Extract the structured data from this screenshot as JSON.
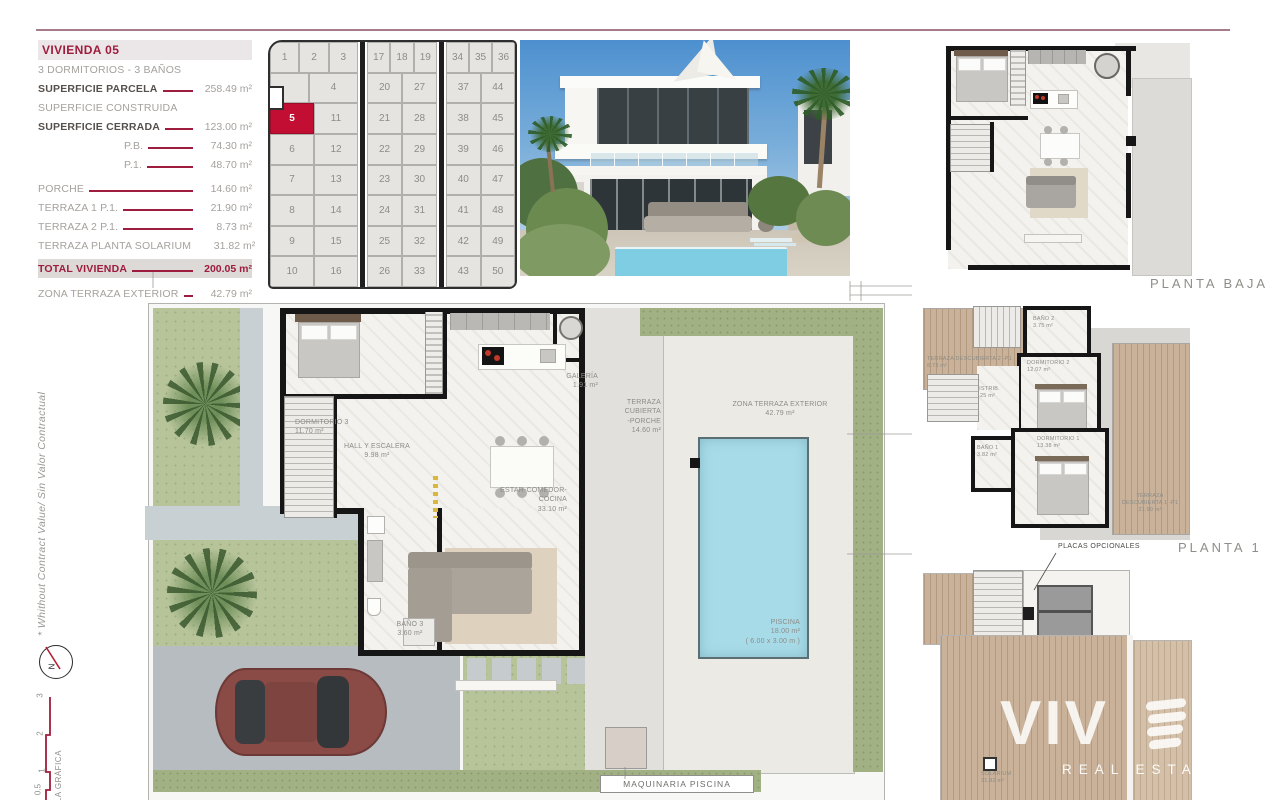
{
  "sheet": {
    "disclaimer": "* Whithout Contract Value/ Sin Valor Contractual",
    "compass_label": "N",
    "scale_title": "ESCALA GRÁFICA",
    "scale_ticks": [
      "3",
      "2",
      "1",
      "0.5"
    ]
  },
  "spec_panel": {
    "title": "VIVIENDA 05",
    "subtitle": "3 DORMITORIOS - 3 BAÑOS",
    "rows": [
      {
        "label": "SUPERFICIE PARCELA",
        "value": "258.49 m²"
      },
      {
        "label": "SUPERFICIE CONSTRUIDA",
        "value": ""
      },
      {
        "label": "SUPERFICIE CERRADA",
        "value": "123.00 m²"
      },
      {
        "label": "P.B.",
        "value": "74.30 m²"
      },
      {
        "label": "P.1.",
        "value": "48.70 m²"
      },
      {
        "label": "PORCHE",
        "value": "14.60 m²"
      },
      {
        "label": "TERRAZA 1 P.1.",
        "value": "21.90 m²"
      },
      {
        "label": "TERRAZA 2 P.1.",
        "value": "8.73 m²"
      },
      {
        "label": "TERRAZA PLANTA SOLARIUM",
        "value": "31.82 m²"
      },
      {
        "label": "TOTAL VIVIENDA",
        "value": "200.05 m²"
      },
      {
        "label": "ZONA TERRAZA EXTERIOR",
        "value": "42.79 m²"
      }
    ]
  },
  "site_grid": {
    "highlighted_plot": "5",
    "block_a": {
      "row1": [
        "1",
        "2",
        "3"
      ],
      "row2": [
        "",
        "4"
      ],
      "rows": [
        [
          "5",
          "11"
        ],
        [
          "6",
          "12"
        ],
        [
          "7",
          "13"
        ],
        [
          "8",
          "14"
        ],
        [
          "9",
          "15"
        ],
        [
          "10",
          "16"
        ]
      ]
    },
    "block_b": {
      "row1": [
        "17",
        "18",
        "19"
      ],
      "rows": [
        [
          "20",
          "27"
        ],
        [
          "21",
          "28"
        ],
        [
          "22",
          "29"
        ],
        [
          "23",
          "30"
        ],
        [
          "24",
          "31"
        ],
        [
          "25",
          "32"
        ],
        [
          "26",
          "33"
        ]
      ]
    },
    "block_c": {
      "row1": [
        "34",
        "35",
        "36"
      ],
      "rows": [
        [
          "37",
          "44"
        ],
        [
          "38",
          "45"
        ],
        [
          "39",
          "46"
        ],
        [
          "40",
          "47"
        ],
        [
          "41",
          "48"
        ],
        [
          "42",
          "49"
        ],
        [
          "43",
          "50"
        ]
      ]
    }
  },
  "main_plan": {
    "rooms": {
      "dormitorio3": {
        "name": "DORMITORIO 3",
        "area": "11.70 m²"
      },
      "hall": {
        "name": "HALL Y ESCALERA",
        "area": "9.98 m²"
      },
      "galeria": {
        "name": "GALERÍA",
        "area": "1.91 m²"
      },
      "estar": {
        "name": "ESTAR-COMEDOR-COCINA",
        "area": "33.10 m²"
      },
      "bano3": {
        "name": "BAÑO 3",
        "area": "3.60 m²"
      },
      "porche": {
        "name": "TERRAZA CUBIERTA",
        "name2": "-PORCHE",
        "area": "14.60 m²"
      },
      "zona_exterior": {
        "name": "ZONA TERRAZA EXTERIOR",
        "area": "42.79 m²"
      },
      "piscina": {
        "name": "PISCINA",
        "area": "18.00 m²",
        "dims": "( 6.00 x 3.00 m )"
      },
      "maquinaria": {
        "name": "MAQUINARIA PISCINA"
      }
    }
  },
  "planta_baja": {
    "label": "PLANTA BAJA"
  },
  "planta_1": {
    "label": "PLANTA 1",
    "note": "PLACAS OPCIONALES",
    "rooms": {
      "terraza2": {
        "name": "TERRAZA DESCUBIERTA 2 -P1",
        "area": "8.73 m²"
      },
      "bano2": {
        "name": "BAÑO 2",
        "area": "3.75 m²"
      },
      "dormitorio2": {
        "name": "DORMITORIO 2",
        "area": "12.07 m²"
      },
      "distrib": {
        "name": "DISTRIB.",
        "area": "2.25 m²"
      },
      "bano1": {
        "name": "BAÑO 1",
        "area": "3.82 m²"
      },
      "dormitorio1": {
        "name": "DORMITORIO 1",
        "area": "13.38 m²"
      },
      "terraza1": {
        "name": "TERRAZA",
        "name2": "DESCUBIERTA 1 -P1",
        "area": "21.90 m²"
      }
    }
  },
  "solarium_plan": {
    "room": {
      "name": "SOLARIUM",
      "area": "31.82 m²"
    }
  },
  "watermark": {
    "brand": "VIV",
    "tagline": "REAL ESTAT"
  },
  "colors": {
    "accent": "#9E1C3D",
    "plot_highlight": "#C30E33",
    "pool": "#A8DBE8"
  }
}
